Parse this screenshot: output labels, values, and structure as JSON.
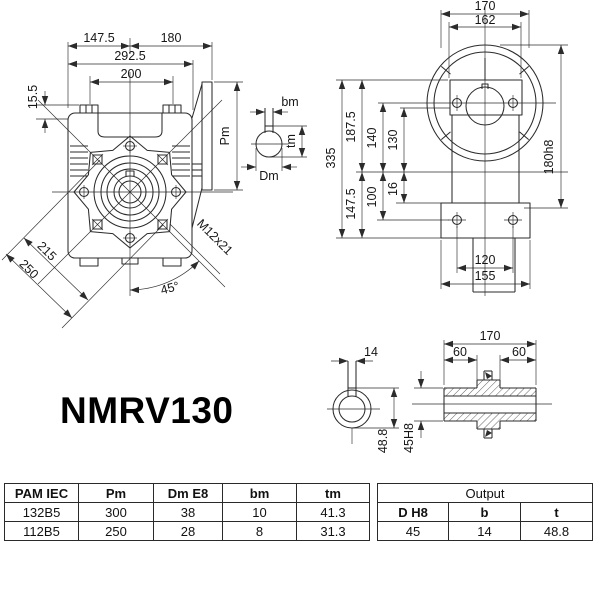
{
  "title": "NMRV130",
  "colors": {
    "ink": "#2b2b2b",
    "background": "#ffffff"
  },
  "front_view": {
    "dim_left": "147.5",
    "dim_right": "180",
    "dim_overall": "292.5",
    "dim_bolt_span": "200",
    "dim_pad": "15.5",
    "dim_diag_bolts": "215",
    "dim_diag_outer": "250",
    "angle": "45°",
    "thread": "M12x21",
    "flange_height": "Pm"
  },
  "input_detail": {
    "key_width": "bm",
    "key_depth": "tm",
    "bore_dia": "Dm"
  },
  "side_view": {
    "dim_top": "170",
    "dim_flange": "162",
    "dim_height": "335",
    "dim_upper": "187.5",
    "dim_lower": "147.5",
    "dim_axis": "140",
    "dim_foot_hole": "100",
    "dim_pilot": "130",
    "dim_foot_pad": "16",
    "dim_spigot": "180h8",
    "dim_foot_holes": "120",
    "dim_foot_width": "155"
  },
  "output_detail": {
    "key_width": "14",
    "key_depth": "48.8",
    "bore": "45H8",
    "dim_length": "170",
    "dim_end_left": "60",
    "dim_end_right": "60"
  },
  "tables": {
    "pam": {
      "headers": [
        "PAM IEC",
        "Pm",
        "Dm E8",
        "bm",
        "tm"
      ],
      "rows": [
        [
          "132B5",
          "300",
          "38",
          "10",
          "41.3"
        ],
        [
          "112B5",
          "250",
          "28",
          "8",
          "31.3"
        ]
      ]
    },
    "output": {
      "title": "Output",
      "headers": [
        "D H8",
        "b",
        "t"
      ],
      "rows": [
        [
          "45",
          "14",
          "48.8"
        ]
      ]
    }
  }
}
